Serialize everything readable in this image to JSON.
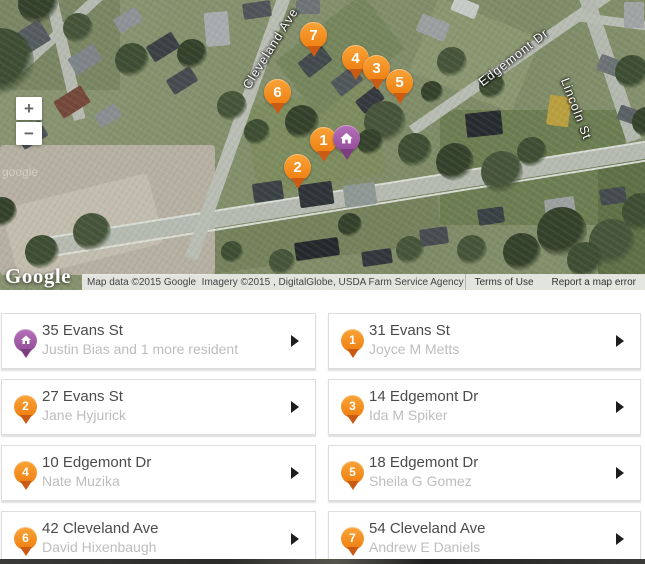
{
  "map": {
    "street_labels": [
      {
        "text": "Cleveland Ave"
      },
      {
        "text": "Edgemont Dr"
      },
      {
        "text": "Lincoln St"
      }
    ],
    "watermark": "google",
    "zoom_in_label": "+",
    "zoom_out_label": "−",
    "markers": [
      {
        "label": "1"
      },
      {
        "label": "2"
      },
      {
        "label": "3"
      },
      {
        "label": "4"
      },
      {
        "label": "5"
      },
      {
        "label": "6"
      },
      {
        "label": "7"
      },
      {
        "type": "home"
      }
    ],
    "marker_colors": {
      "orange": "#f6861f",
      "orange_tail": "#ca5b15",
      "purple": "#9a4d9e",
      "purple_tail": "#7c3d80"
    },
    "attribution": {
      "logo": "Google",
      "map_data": "Map data ©2015 Google  Imagery ©2015 , DigitalGlobe, USDA Farm Service Agency",
      "terms": "Terms of Use",
      "report": "Report a map error"
    }
  },
  "cards": [
    {
      "pin": "home",
      "address": "35 Evans St",
      "residents": "Justin Bias and 1 more resident"
    },
    {
      "pin": "1",
      "address": "31 Evans St",
      "residents": "Joyce M Metts"
    },
    {
      "pin": "2",
      "address": "27 Evans St",
      "residents": "Jane Hyjurick"
    },
    {
      "pin": "3",
      "address": "14 Edgemont Dr",
      "residents": "Ida M Spiker"
    },
    {
      "pin": "4",
      "address": "10 Edgemont Dr",
      "residents": "Nate Muzika"
    },
    {
      "pin": "5",
      "address": "18 Edgemont Dr",
      "residents": "Sheila G Gomez"
    },
    {
      "pin": "6",
      "address": "42 Cleveland Ave",
      "residents": "David Hixenbaugh"
    },
    {
      "pin": "7",
      "address": "54 Cleveland Ave",
      "residents": "Andrew E Daniels"
    }
  ]
}
